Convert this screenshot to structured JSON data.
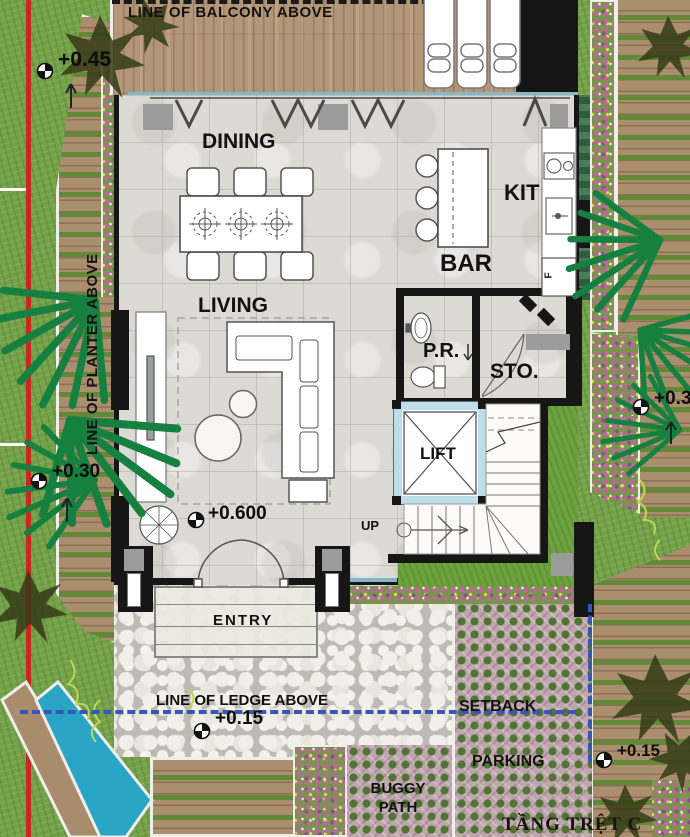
{
  "plan": {
    "title": "TẦNG TRỆT C",
    "notes": {
      "balcony": "LINE OF BALCONY ABOVE",
      "planter": "LINE OF PLANTER ABOVE",
      "ledge": "LINE OF LEDGE ABOVE"
    },
    "rooms": {
      "dining": "DINING",
      "kitchen": "KIT",
      "bar": "BAR",
      "living": "LIVING",
      "powder_room": "P.R.",
      "storage": "STO.",
      "lift": "LIFT",
      "entry": "ENTRY"
    },
    "circulation": {
      "up": "UP"
    },
    "fixtures": {
      "fridge": "F"
    },
    "site": {
      "setback": "SETBACK",
      "parking": "PARKING",
      "buggy_path": "BUGGY PATH"
    },
    "levels": {
      "planter": "+0.45",
      "walkway_left": "+0.30",
      "walkway_right": "+0.3",
      "living": "+0.600",
      "entry": "+0.15",
      "parking": "+0.15"
    },
    "colors": {
      "boundary_red": "#c8281e",
      "setback_blue": "#3a56b4",
      "water_blue": "#2aa5c6",
      "label_ink": "#121212"
    }
  }
}
